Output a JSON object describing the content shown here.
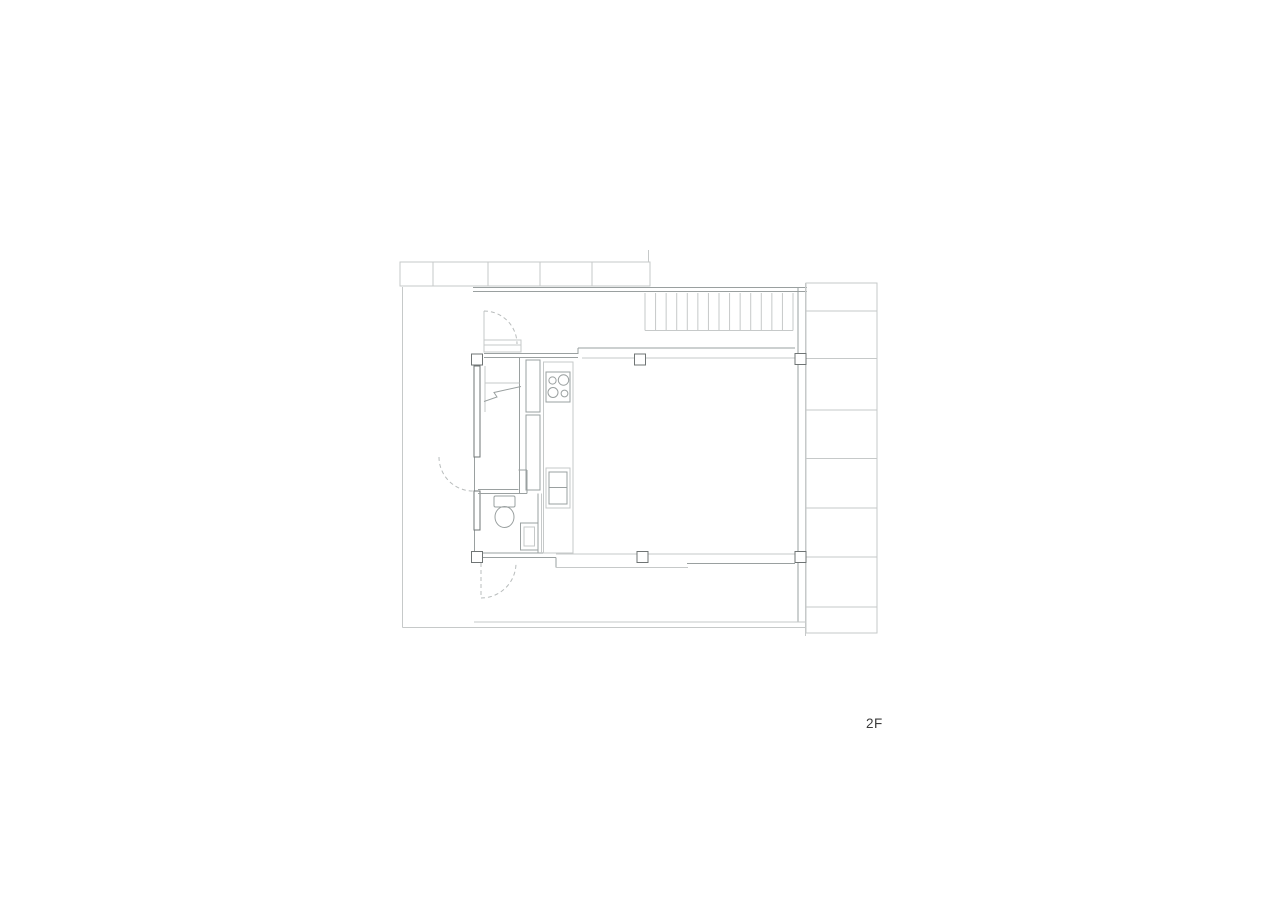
{
  "floor_label": "2F",
  "colors": {
    "background": "#ffffff",
    "line_light": "#c6c9c9",
    "line_medium": "#9aa0a0",
    "line_dark": "#6f7474",
    "dashed": "#b8bcbc",
    "label_text": "#3b3b3b"
  },
  "drawing": {
    "width": 1280,
    "height": 904,
    "elements": [
      {
        "type": "rect",
        "name": "top-eave-band",
        "x": 400,
        "y": 262,
        "w": 250,
        "h": 24,
        "stroke": "L"
      },
      {
        "type": "vlines",
        "name": "top-eave-divider",
        "xs": [
          433,
          488,
          540,
          592
        ],
        "y1": 262,
        "y2": 286,
        "stroke": "L"
      },
      {
        "type": "line",
        "name": "top-eave-right-tick",
        "x1": 648.5,
        "y1": 250,
        "x2": 648.5,
        "y2": 262,
        "stroke": "L"
      },
      {
        "type": "line",
        "name": "north-exterior-wall-outer",
        "x1": 473,
        "y1": 287.5,
        "x2": 807,
        "y2": 287.5,
        "stroke": "M"
      },
      {
        "type": "line",
        "name": "north-exterior-wall-inner",
        "x1": 473,
        "y1": 291.5,
        "x2": 807,
        "y2": 291.5,
        "stroke": "M"
      },
      {
        "type": "vlines",
        "name": "stair-treads",
        "x1": 645,
        "x2": 793,
        "count": 15,
        "y1": 293,
        "y2": 330.5,
        "stroke": "L"
      },
      {
        "type": "line",
        "name": "stair-bottom-edge",
        "x1": 645,
        "y1": 330.5,
        "x2": 793,
        "y2": 330.5,
        "stroke": "L"
      },
      {
        "type": "line",
        "name": "east-exterior-wall-outer",
        "x1": 805.5,
        "y1": 283,
        "x2": 805.5,
        "y2": 636,
        "stroke": "L"
      },
      {
        "type": "line",
        "name": "east-exterior-wall-inner",
        "x1": 798,
        "y1": 288,
        "x2": 798,
        "y2": 622,
        "stroke": "M"
      },
      {
        "type": "rect",
        "name": "balcony-strip",
        "x": 806,
        "y": 283,
        "w": 71,
        "h": 350,
        "stroke": "L"
      },
      {
        "type": "hlines",
        "name": "balcony-plank-joint",
        "ys": [
          311,
          358.5,
          410,
          458.5,
          508,
          557,
          607
        ],
        "x1": 806,
        "x2": 877,
        "stroke": "L"
      },
      {
        "type": "line",
        "name": "west-terrace-boundary",
        "x1": 402.5,
        "y1": 287,
        "x2": 402.5,
        "y2": 627.5,
        "stroke": "L"
      },
      {
        "type": "line",
        "name": "south-terrace-edge-outer",
        "x1": 402.5,
        "y1": 627.5,
        "x2": 806,
        "y2": 627.5,
        "stroke": "L"
      },
      {
        "type": "line",
        "name": "south-terrace-edge-inner",
        "x1": 474,
        "y1": 622,
        "x2": 805,
        "y2": 622,
        "stroke": "L"
      },
      {
        "type": "line",
        "name": "north-window-upper-track",
        "x1": 578,
        "y1": 348,
        "x2": 795,
        "y2": 348,
        "stroke": "M"
      },
      {
        "type": "line",
        "name": "north-wall-jog",
        "x1": 578,
        "y1": 348,
        "x2": 578,
        "y2": 354,
        "stroke": "M"
      },
      {
        "type": "line",
        "name": "kitchen-north-wall-outer",
        "x1": 484,
        "y1": 353.5,
        "x2": 578,
        "y2": 353.5,
        "stroke": "M"
      },
      {
        "type": "line",
        "name": "kitchen-north-wall-inner",
        "x1": 484,
        "y1": 357.5,
        "x2": 578,
        "y2": 357.5,
        "stroke": "M"
      },
      {
        "type": "line",
        "name": "north-window-lower-track",
        "x1": 582,
        "y1": 358,
        "x2": 797,
        "y2": 358,
        "stroke": "L"
      },
      {
        "type": "line",
        "name": "wc-south-wall-outer",
        "x1": 483,
        "y1": 553,
        "x2": 556,
        "y2": 553,
        "stroke": "M"
      },
      {
        "type": "line",
        "name": "wc-south-wall-inner",
        "x1": 473,
        "y1": 557.5,
        "x2": 556,
        "y2": 557.5,
        "stroke": "M"
      },
      {
        "type": "line",
        "name": "south-wall-step",
        "x1": 556,
        "y1": 557.5,
        "x2": 556,
        "y2": 567.5,
        "stroke": "M"
      },
      {
        "type": "line",
        "name": "south-window-track",
        "x1": 556,
        "y1": 554,
        "x2": 797,
        "y2": 554,
        "stroke": "L"
      },
      {
        "type": "line",
        "name": "south-slide-panel-left",
        "x1": 556,
        "y1": 567.5,
        "x2": 688,
        "y2": 567.5,
        "stroke": "L"
      },
      {
        "type": "line",
        "name": "south-slide-panel-right",
        "x1": 687,
        "y1": 563.5,
        "x2": 795,
        "y2": 563.5,
        "stroke": "M"
      },
      {
        "type": "line",
        "name": "west-interior-wall",
        "x1": 474.5,
        "y1": 366,
        "x2": 474.5,
        "y2": 552,
        "stroke": "M"
      },
      {
        "type": "rect",
        "name": "west-wall-solid-upper",
        "x": 474,
        "y": 366,
        "w": 6,
        "h": 91,
        "stroke": "D",
        "fill": "#ffffff"
      },
      {
        "type": "rect",
        "name": "west-wall-solid-lower",
        "x": 474,
        "y": 491,
        "w": 6,
        "h": 39,
        "stroke": "D",
        "fill": "#ffffff"
      },
      {
        "type": "rect",
        "name": "entry-cabinet",
        "x": 484,
        "y": 340,
        "w": 37,
        "h": 12,
        "stroke": "L"
      },
      {
        "type": "line",
        "name": "entry-cabinet-shelf",
        "x1": 484,
        "y1": 345,
        "x2": 521,
        "y2": 345,
        "stroke": "L"
      },
      {
        "type": "line",
        "name": "entry-door-jamb",
        "x1": 484,
        "y1": 311,
        "x2": 484,
        "y2": 340,
        "stroke": "L"
      },
      {
        "type": "path",
        "name": "entry-door-swing-arc",
        "d": "M 484 311 A 33 33 0 0 1 517 344",
        "stroke": "dash",
        "dash": "4 3"
      },
      {
        "type": "path",
        "name": "west-door-swing-arc",
        "d": "M 439 457 A 34 34 0 0 0 473 491",
        "stroke": "dash",
        "dash": "4 3"
      },
      {
        "type": "line",
        "name": "kitchen-west-wall",
        "x1": 519.5,
        "y1": 357.5,
        "x2": 519.5,
        "y2": 493.5,
        "stroke": "M"
      },
      {
        "type": "line",
        "name": "stair-nook-left-edge",
        "x1": 485,
        "y1": 366,
        "x2": 485,
        "y2": 412,
        "stroke": "L"
      },
      {
        "type": "line",
        "name": "stair-nook-shelf",
        "x1": 485,
        "y1": 383,
        "x2": 519.5,
        "y2": 383,
        "stroke": "L"
      },
      {
        "type": "path",
        "name": "stair-break-line",
        "d": "M 484 401.5 L 497 397 L 494 392.5 L 521 386.5",
        "stroke": "M"
      },
      {
        "type": "rect",
        "name": "kitchen-tall-cabinet",
        "x": 526,
        "y": 360,
        "w": 14,
        "h": 52,
        "stroke": "M"
      },
      {
        "type": "rect",
        "name": "kitchen-refrigerator",
        "x": 526,
        "y": 415,
        "w": 14,
        "h": 75,
        "stroke": "M"
      },
      {
        "type": "line",
        "name": "duct-right-edge",
        "x1": 527,
        "y1": 470,
        "x2": 527,
        "y2": 493.5,
        "stroke": "M"
      },
      {
        "type": "line",
        "name": "duct-top-edge",
        "x1": 518.5,
        "y1": 470,
        "x2": 527,
        "y2": 470,
        "stroke": "M"
      },
      {
        "type": "line",
        "name": "wc-north-wall-outer",
        "x1": 478,
        "y1": 489.5,
        "x2": 518.5,
        "y2": 489.5,
        "stroke": "M"
      },
      {
        "type": "line",
        "name": "wc-north-wall-inner",
        "x1": 478,
        "y1": 493.5,
        "x2": 527,
        "y2": 493.5,
        "stroke": "M"
      },
      {
        "type": "line",
        "name": "wc-east-wall",
        "x1": 538,
        "y1": 493.5,
        "x2": 538,
        "y2": 553,
        "stroke": "M"
      },
      {
        "type": "line",
        "name": "wc-east-wall-outer",
        "x1": 541.5,
        "y1": 493.5,
        "x2": 541.5,
        "y2": 553,
        "stroke": "L"
      },
      {
        "type": "rect",
        "name": "toilet-tank",
        "x": 494,
        "y": 496,
        "w": 21,
        "h": 11,
        "rx": 1.5,
        "stroke": "M"
      },
      {
        "type": "ellipse",
        "name": "toilet-bowl",
        "cx": 504.5,
        "cy": 517,
        "rx": 9.5,
        "ry": 10.5,
        "stroke": "M"
      },
      {
        "type": "rect",
        "name": "washbasin",
        "x": 520.5,
        "y": 523,
        "w": 17.5,
        "h": 27,
        "stroke": "M"
      },
      {
        "type": "rect",
        "name": "washbasin-inner",
        "x": 524,
        "y": 527,
        "w": 10.5,
        "h": 19,
        "stroke": "L"
      },
      {
        "type": "line",
        "name": "wc-door-leaf",
        "x1": 481,
        "y1": 563,
        "x2": 481,
        "y2": 598,
        "stroke": "dash",
        "dash": "4 3"
      },
      {
        "type": "path",
        "name": "wc-door-swing-arc",
        "d": "M 481 598 A 35 35 0 0 0 516 563",
        "stroke": "dash",
        "dash": "4 3"
      },
      {
        "type": "rect",
        "name": "kitchen-counter",
        "x": 543.5,
        "y": 362,
        "w": 29.5,
        "h": 191,
        "stroke": "L"
      },
      {
        "type": "rect",
        "name": "cooktop",
        "x": 546,
        "y": 372,
        "w": 24,
        "h": 30,
        "stroke": "M"
      },
      {
        "type": "circle",
        "name": "cooktop-burner",
        "cx": 552.5,
        "cy": 380.5,
        "r": 3.6,
        "stroke": "M"
      },
      {
        "type": "circle",
        "name": "cooktop-burner",
        "cx": 563.5,
        "cy": 380,
        "r": 5.2,
        "stroke": "M"
      },
      {
        "type": "circle",
        "name": "cooktop-burner",
        "cx": 553,
        "cy": 392.5,
        "r": 5,
        "stroke": "M"
      },
      {
        "type": "circle",
        "name": "cooktop-burner",
        "cx": 564.5,
        "cy": 393.5,
        "r": 3.4,
        "stroke": "M"
      },
      {
        "type": "rect",
        "name": "kitchen-sink",
        "x": 546,
        "y": 468,
        "w": 24,
        "h": 40,
        "stroke": "L"
      },
      {
        "type": "rect",
        "name": "kitchen-sink-basin",
        "x": 549,
        "y": 472,
        "w": 18,
        "h": 32,
        "stroke": "M"
      },
      {
        "type": "line",
        "name": "kitchen-sink-divider",
        "x1": 549,
        "y1": 487.5,
        "x2": 567,
        "y2": 487.5,
        "stroke": "M"
      },
      {
        "type": "rect",
        "name": "column",
        "x": 471.5,
        "y": 354,
        "w": 11,
        "h": 11,
        "stroke": "D",
        "fill": "#ffffff"
      },
      {
        "type": "rect",
        "name": "column",
        "x": 634.5,
        "y": 354,
        "w": 11,
        "h": 11,
        "stroke": "D",
        "fill": "#ffffff"
      },
      {
        "type": "rect",
        "name": "column",
        "x": 795,
        "y": 353.5,
        "w": 11,
        "h": 11,
        "stroke": "D",
        "fill": "#ffffff"
      },
      {
        "type": "rect",
        "name": "column",
        "x": 471.5,
        "y": 551.5,
        "w": 11,
        "h": 11,
        "stroke": "D",
        "fill": "#ffffff"
      },
      {
        "type": "rect",
        "name": "column",
        "x": 637,
        "y": 551.5,
        "w": 11,
        "h": 11,
        "stroke": "D",
        "fill": "#ffffff"
      },
      {
        "type": "rect",
        "name": "column",
        "x": 795,
        "y": 551.5,
        "w": 11,
        "h": 11,
        "stroke": "D",
        "fill": "#ffffff"
      }
    ]
  }
}
